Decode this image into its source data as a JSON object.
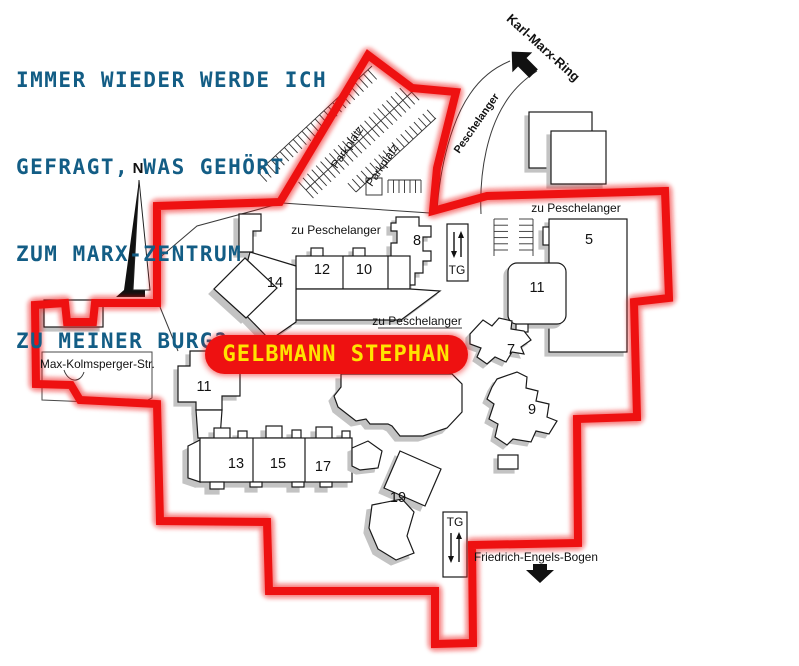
{
  "header": {
    "line1": "IMMER WIEDER WERDE ICH",
    "line2": "GEFRAGT, WAS GEHÖRT",
    "line3": "ZUM MARX-ZENTRUM",
    "line4": "ZU MEINER BURG?"
  },
  "banner": {
    "name": "GELBMANN STEPHAN"
  },
  "compass": {
    "north": "N"
  },
  "streets": {
    "karl_marx_ring": "Karl-Marx-Ring",
    "peschelanger": "Peschelanger",
    "zu_peschelanger_top": "zu Peschelanger",
    "zu_peschelanger_east": "zu Peschelanger",
    "zu_peschelanger_mid": "zu Peschelanger",
    "max_kolmsperger": "Max-Kolmsperger-Str.",
    "friedrich_engels_bogen": "Friedrich-Engels-Bogen"
  },
  "parking": {
    "lot1": "Parkplatz",
    "lot2": "Parkplatz",
    "garage_top": "TG",
    "garage_bottom": "TG"
  },
  "buildings": {
    "b5": "5",
    "b7": "7",
    "b8": "8",
    "b9": "9",
    "b10": "10",
    "b11_east": "11",
    "b11_west": "11",
    "b12": "12",
    "b13": "13",
    "b14": "14",
    "b15": "15",
    "b17": "17",
    "b19": "19"
  },
  "colors": {
    "boundary_red": "#ee1111",
    "banner_text_yellow": "#ffe400",
    "header_blue": "#135d85",
    "shadow_gray": "#c3c3c3",
    "ink": "#1a1a1a"
  }
}
